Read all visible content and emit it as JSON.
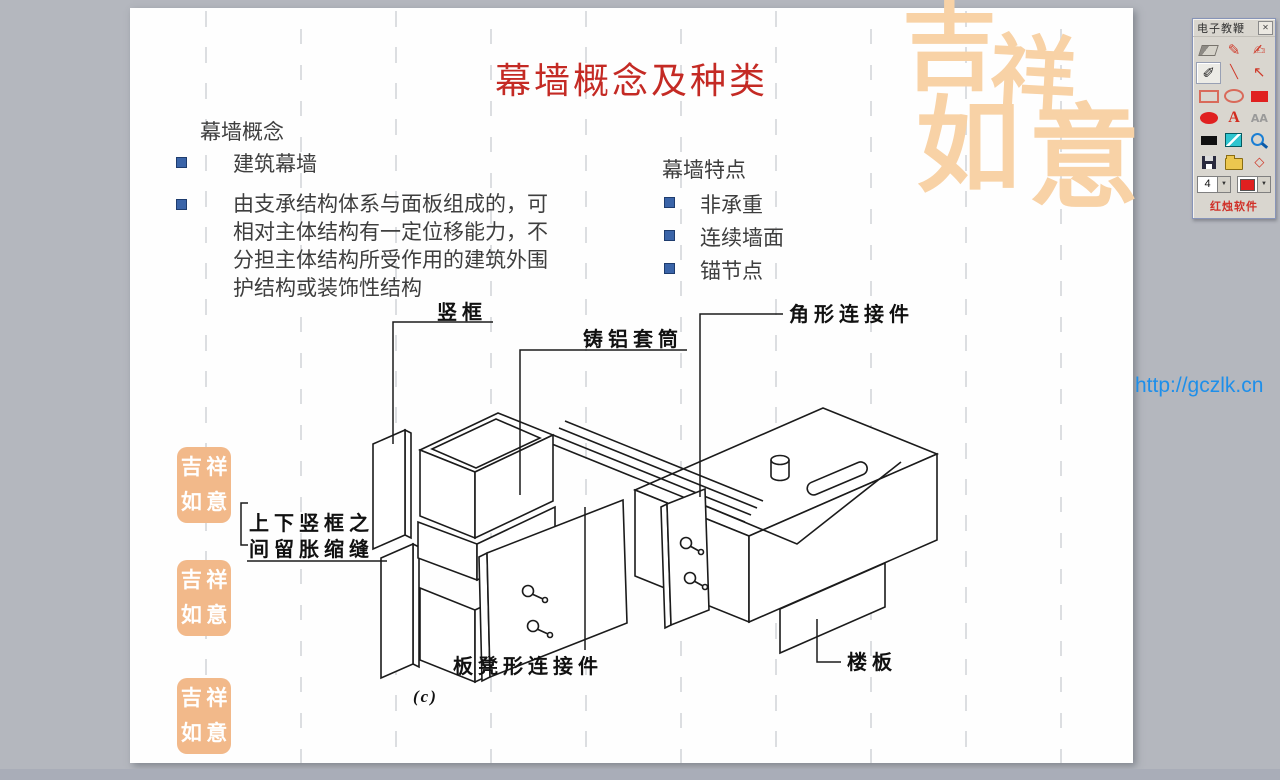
{
  "window": {
    "bg_color": "#b4b7be",
    "accent_red": "#c42a24",
    "link_blue": "#1e8fea",
    "bullet_blue": "#3a64a8",
    "watermark_peach": "#f8d2a6"
  },
  "slide": {
    "title": "幕墙概念及种类",
    "concept": {
      "heading": "幕墙概念",
      "item1": "建筑幕墙",
      "item2": "由支承结构体系与面板组成的，可相对主体结构有一定位移能力，不分担主体结构所受作用的建筑外围护结构或装饰性结构"
    },
    "features": {
      "heading": "幕墙特点",
      "items": [
        "非承重",
        "连续墙面",
        "锚节点"
      ]
    },
    "diagram": {
      "caption": "(c)",
      "labels": {
        "mullion": "竖框",
        "sleeve": "铸铝套筒",
        "angle_connector": "角形连接件",
        "expansion1": "上下竖框之",
        "expansion2": "间留胀缩缝",
        "bench_connector": "板凳形连接件",
        "floor_slab": "楼板"
      }
    },
    "watermark": {
      "char1": "吉",
      "char2": "祥",
      "char3": "如",
      "char4": "意"
    }
  },
  "overlay": {
    "url_text": "http://gczlk.cn"
  },
  "toolbar": {
    "title": "电子教鞭",
    "brand": "红烛软件",
    "pen_size": "4",
    "swatch_color": "#e02020",
    "close_glyph": "✕",
    "dropdown_glyph": "▼",
    "icons": {
      "pen": "✎",
      "brush": "✍",
      "draw": "✐",
      "line": "╲",
      "arrow": "↖",
      "text_a": "A",
      "text_aa": "AA",
      "diamond": "◇"
    }
  }
}
